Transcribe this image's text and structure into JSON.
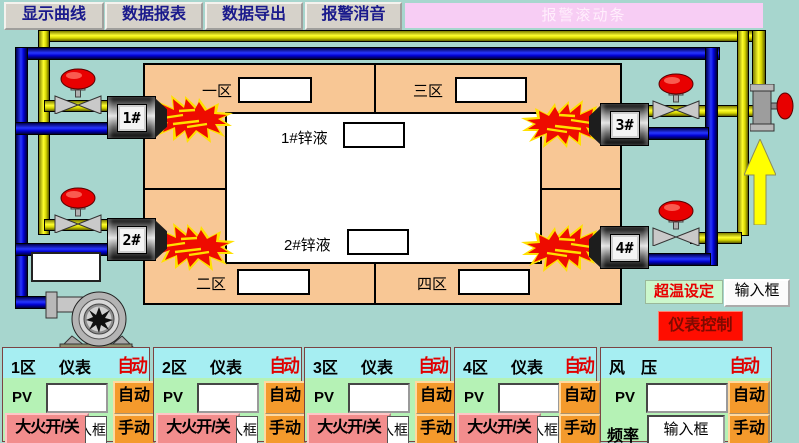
{
  "toolbar": {
    "buttons": [
      "显示曲线",
      "数据报表",
      "数据导出",
      "报警消音"
    ]
  },
  "alarm_bar": {
    "label": "报警滚动条"
  },
  "furnace": {
    "zones": [
      {
        "label": "一区",
        "value": ""
      },
      {
        "label": "三区",
        "value": ""
      },
      {
        "label": "二区",
        "value": ""
      },
      {
        "label": "四区",
        "value": ""
      }
    ],
    "zinc": [
      {
        "label": "1#锌液",
        "value": ""
      },
      {
        "label": "2#锌液",
        "value": ""
      }
    ],
    "burners": [
      "1#",
      "2#",
      "3#",
      "4#"
    ]
  },
  "left_display": {
    "value": ""
  },
  "overtemp": {
    "label": "超温设定",
    "button": "输入框"
  },
  "instrument_control": {
    "label": "仪表控制"
  },
  "panels": [
    {
      "zone": "1区",
      "meter": "仪表",
      "mode": "自动",
      "pv_label": "PV",
      "pv_value": "",
      "auto_btn": "自动",
      "fire_btn": "大火开/关",
      "fire_box": "输入框",
      "manual_btn": "手动"
    },
    {
      "zone": "2区",
      "meter": "仪表",
      "mode": "自动",
      "pv_label": "PV",
      "pv_value": "",
      "auto_btn": "自动",
      "fire_btn": "大火开/关",
      "fire_box": "输入框",
      "manual_btn": "手动"
    },
    {
      "zone": "3区",
      "meter": "仪表",
      "mode": "自动",
      "pv_label": "PV",
      "pv_value": "",
      "auto_btn": "自动",
      "fire_btn": "大火开/关",
      "fire_box": "输入框",
      "manual_btn": "手动"
    },
    {
      "zone": "4区",
      "meter": "仪表",
      "mode": "自动",
      "pv_label": "PV",
      "pv_value": "",
      "auto_btn": "自动",
      "fire_btn": "大火开/关",
      "fire_box": "输入框",
      "manual_btn": "手动"
    },
    {
      "zone_a": "风",
      "zone_b": "压",
      "mode": "自动",
      "pv_label": "PV",
      "pv_value": "",
      "auto_btn": "自动",
      "freq_label": "频率",
      "freq_box": "输入框",
      "manual_btn": "手动"
    }
  ],
  "colors": {
    "background_teal": "#a7d6ce",
    "furnace_orange": "#f8c795",
    "pipe_yellow": "#ffff2e",
    "pipe_blue": "#0000cf",
    "panel_green": "#b5f2b5",
    "panel_header_cyan": "#a6eef2",
    "button_orange": "#f49a2c",
    "button_pink": "#f28d8d",
    "alarm_bar_pink": "#f7cdf4",
    "alert_red": "#ff0d00",
    "mode_text_red": "#e00000",
    "toolbar_text_navy": "#1a1a8c"
  }
}
